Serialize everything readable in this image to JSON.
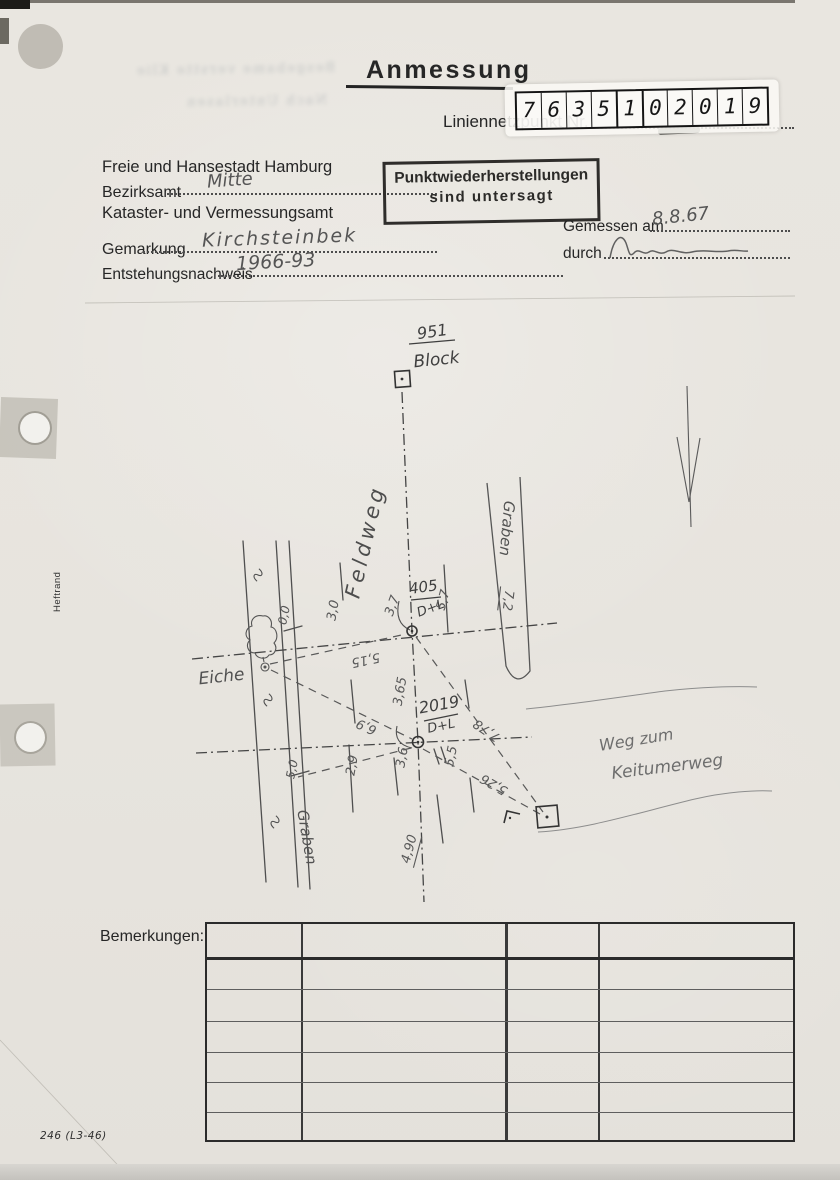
{
  "document": {
    "title": "Anmessung",
    "point_label": "Liniennetzpunkt Nr.",
    "form_number": "246 (L3-46)",
    "margin_label": "Heftrand",
    "bleed_line1": "Besgebame verstte Klie",
    "bleed_line2": "Nach Unterlasen"
  },
  "sticker": {
    "digits": [
      "7",
      "6",
      "3",
      "5",
      "1",
      "0",
      "2",
      "0",
      "1",
      "9"
    ]
  },
  "agency": {
    "line1": "Freie und Hansestadt Hamburg",
    "bezirksamt_label": "Bezirksamt",
    "bezirksamt_value": "Mitte",
    "line2": "Kataster- und Vermessungsamt"
  },
  "fields": {
    "gemarkung_label": "Gemarkung",
    "gemarkung_value": "Kirchsteinbek",
    "entstehung_label": "Entstehungsnachweis",
    "entstehung_value": "1966-93"
  },
  "stamp": {
    "line1": "Punktwiederherstellungen",
    "line2": "sind untersagt"
  },
  "measurement": {
    "date_label": "Gemessen am",
    "date_value": "8.8.67",
    "by_label": "durch"
  },
  "sketch": {
    "points": {
      "top": {
        "number": "951",
        "name": "Block"
      },
      "mid": {
        "number": "405",
        "mark": "D+L"
      },
      "low": {
        "number": "2019",
        "mark": "D+L"
      }
    },
    "labels": {
      "road_axis": "Feldweg",
      "ditch_right": "Graben",
      "ditch_right_width": "7,2",
      "ditch_left": "Graben",
      "tree": "Eiche",
      "dest1": "Weg zum",
      "dest2": "Keitumerweg"
    },
    "measures": {
      "m37": "3,7",
      "m57": "5,7",
      "m515": "5,15",
      "m30": "3,0",
      "m00": "0,0",
      "m365": "3,65",
      "m69": "6,9",
      "m29": "2,9",
      "m50": "5,0",
      "m36": "3,6",
      "m55": "5,5",
      "m778": "7,78",
      "m526": "5,26",
      "m490": "4,90"
    }
  },
  "table": {
    "label": "Bemerkungen:"
  }
}
